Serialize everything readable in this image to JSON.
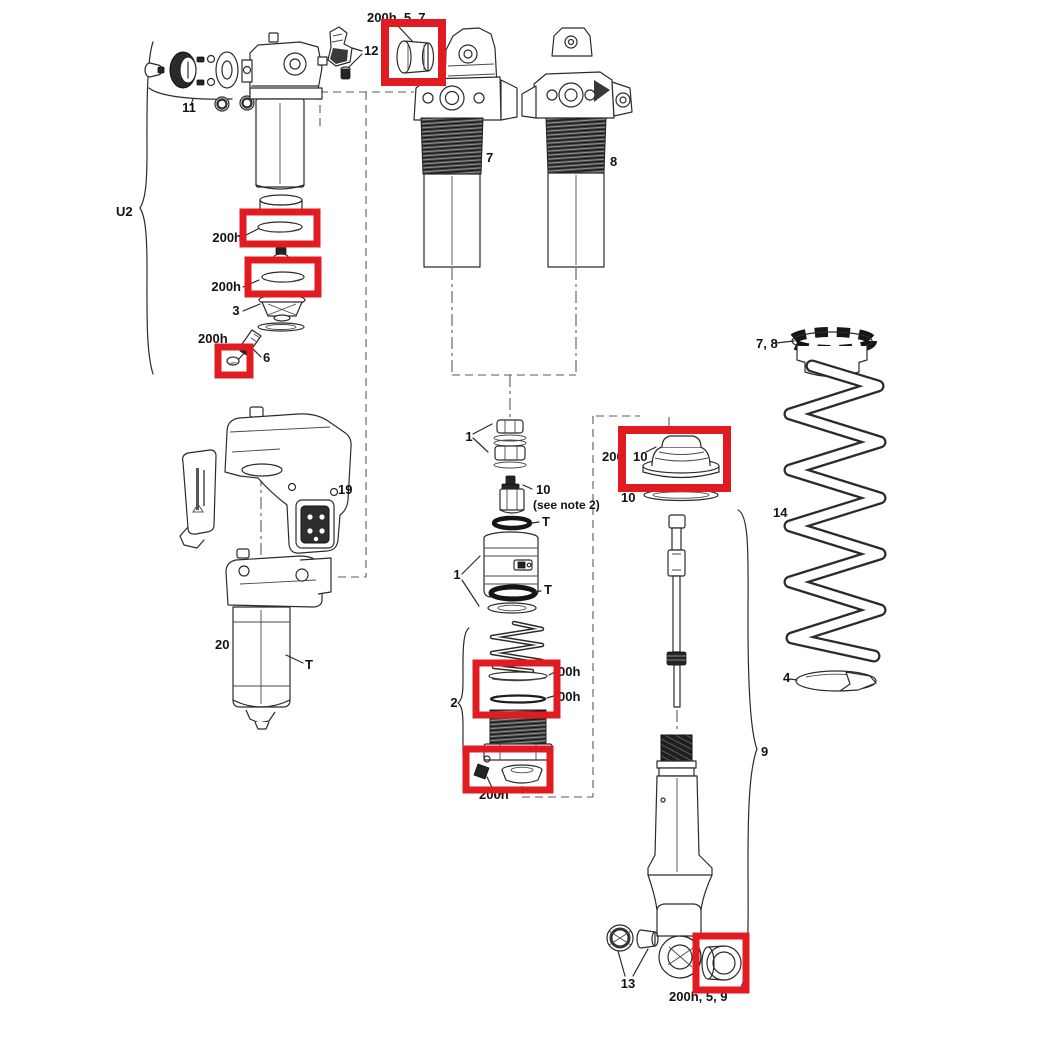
{
  "diagram": {
    "type": "exploded-parts-diagram",
    "subject": "rear shock exploded service parts diagram with red service-kit highlights",
    "colors": {
      "highlight": "#e11b22",
      "line": "#2b2b2b",
      "background": "#ffffff"
    },
    "labels": {
      "top_bushing": "200h, 5, 7",
      "part12": "12",
      "part11": "11",
      "u2": "U2",
      "part7": "7",
      "part8": "8",
      "ring_upper": "200h",
      "ring_lower": "200h",
      "part3": "3",
      "oring_200h": "200h",
      "part6": "6",
      "part19": "19",
      "part20": "20",
      "t_can": "T",
      "one_top": "1",
      "ten_mid": "10",
      "see_note": "(see note 2)",
      "t_upper": "T",
      "one_bottom": "1",
      "t_lower": "T",
      "grp200": "200",
      "ten_box": "10",
      "ten_ring": "10",
      "collar78": "7, 8",
      "part14": "14",
      "part4": "4",
      "part9": "9",
      "part2": "2",
      "ooh_a": "00h",
      "ooh_b": "00h",
      "cap200h": "200h",
      "part13": "13",
      "bottom_bushing": "200h, 5, 9"
    }
  }
}
